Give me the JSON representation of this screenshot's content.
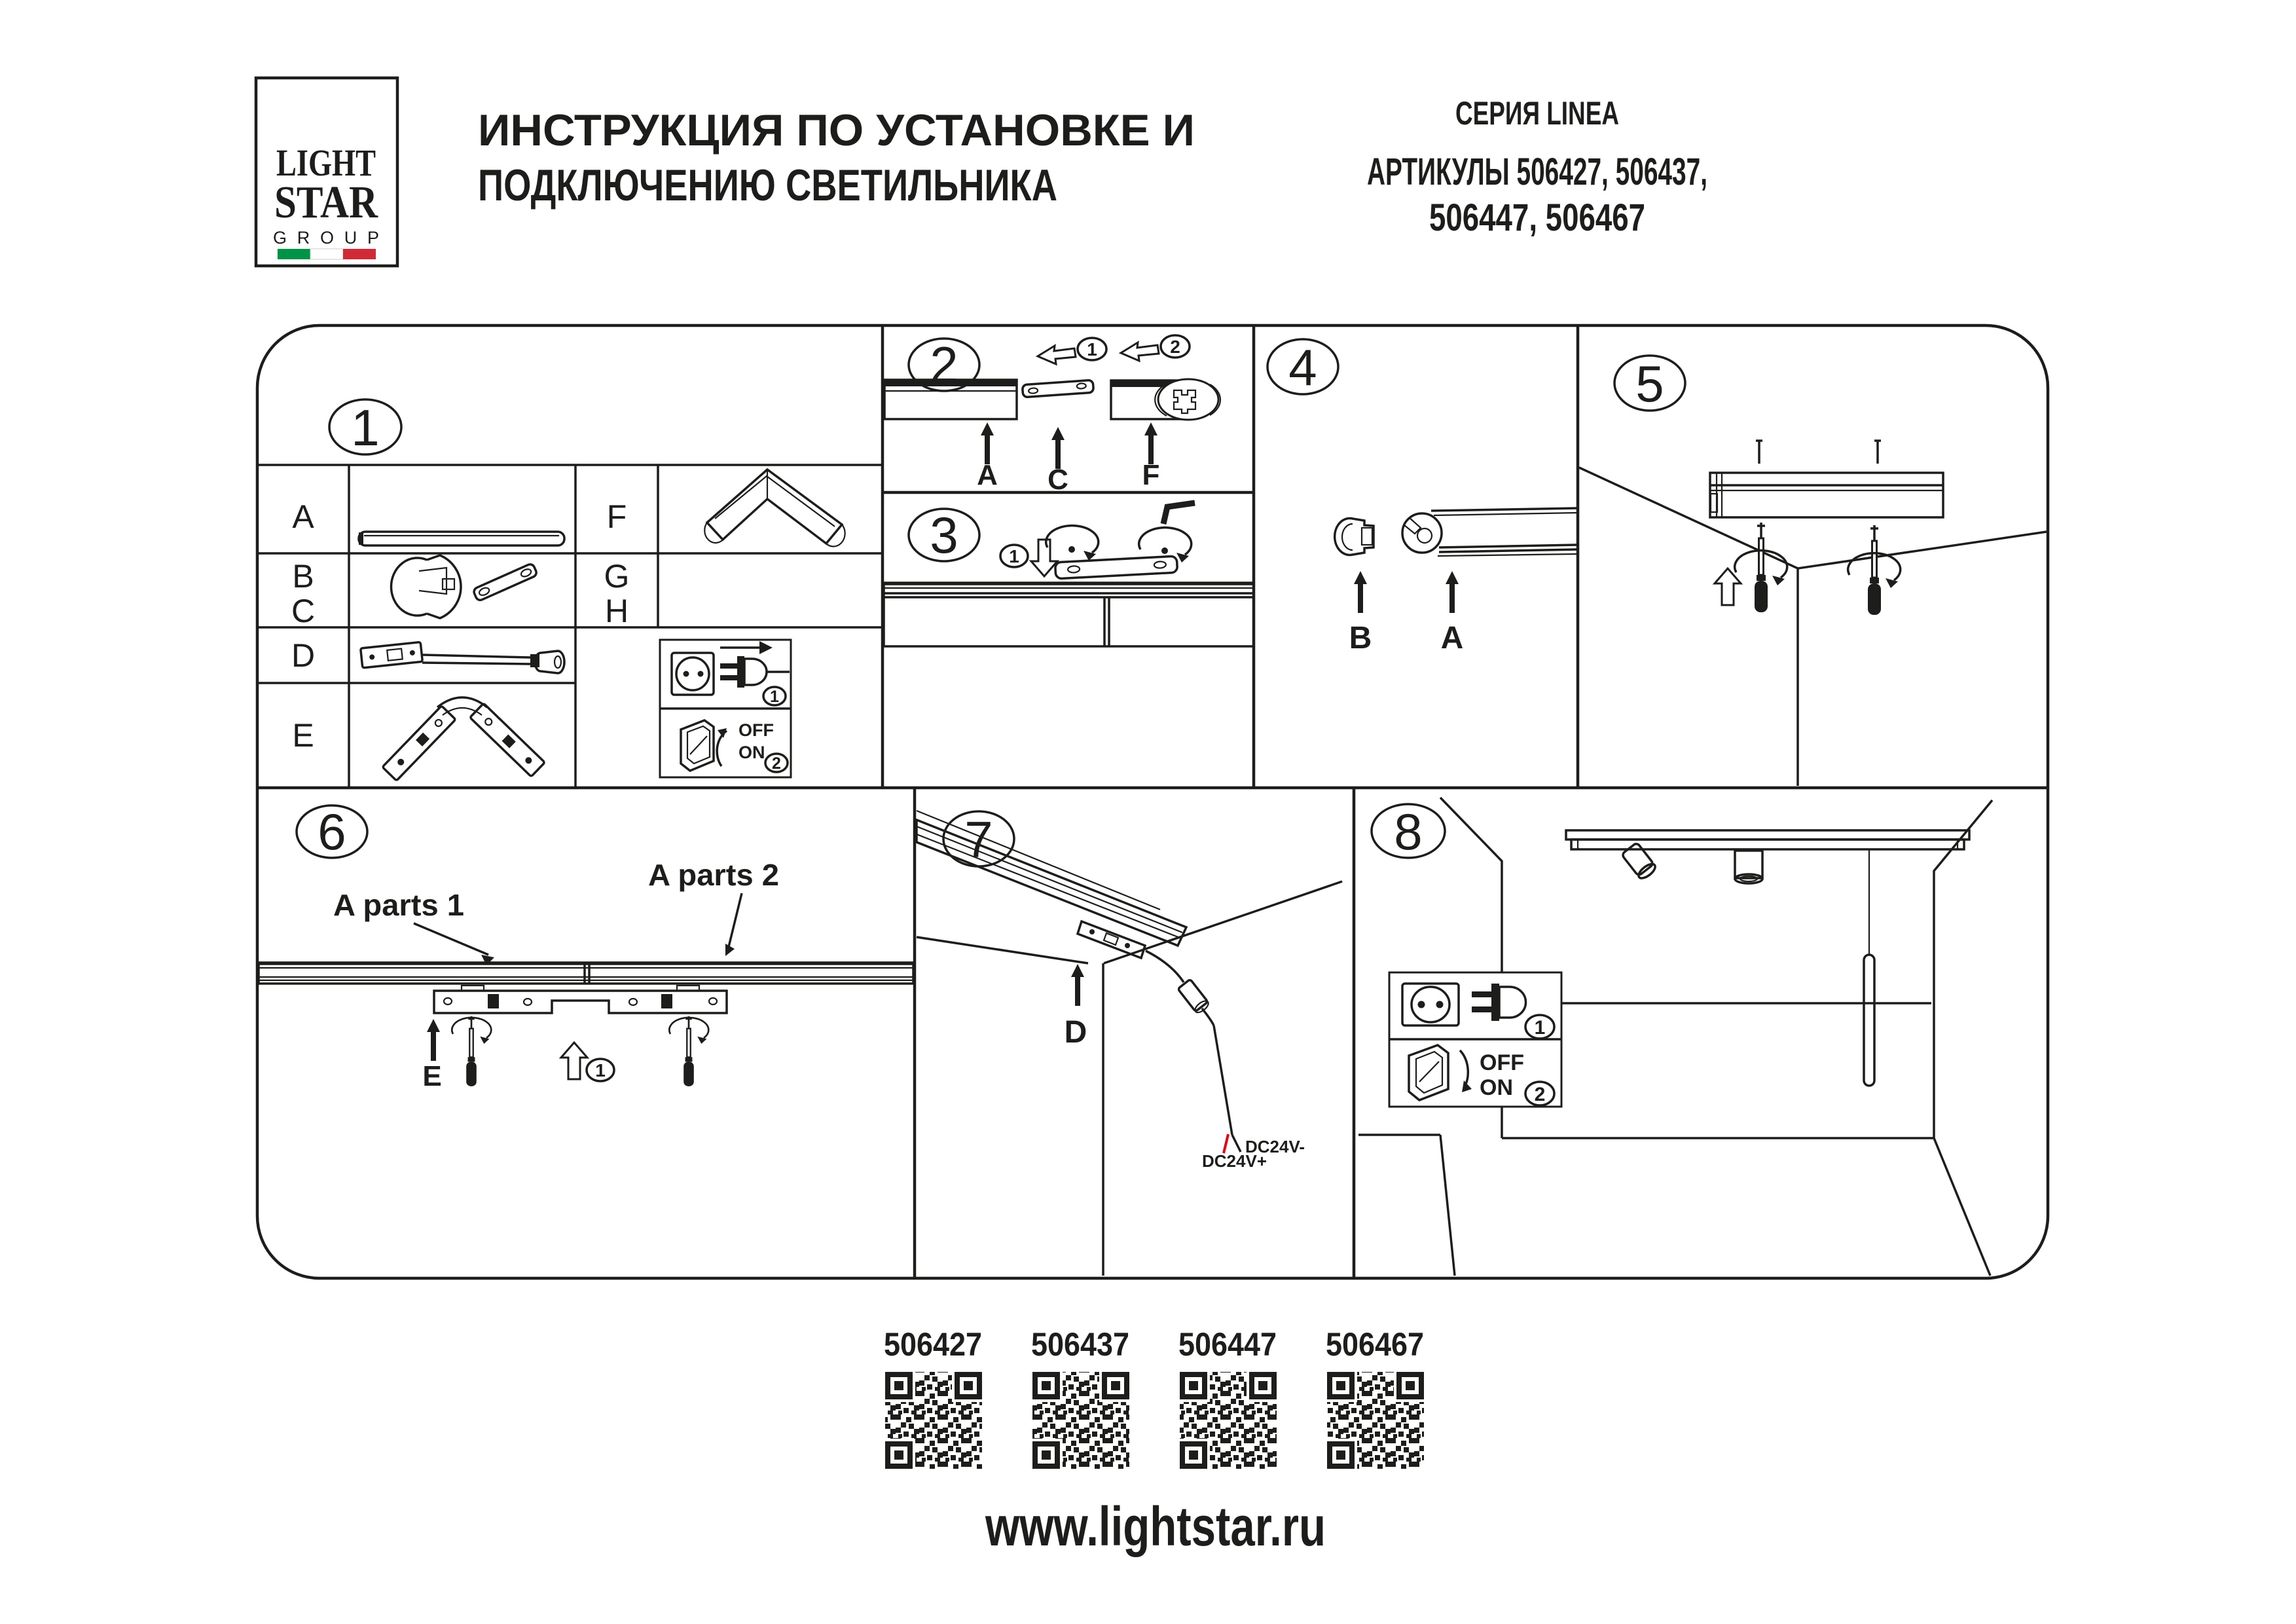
{
  "colors": {
    "ink": "#1d1d1b",
    "flag_green": "#009246",
    "flag_white": "#ffffff",
    "flag_red": "#ce2b37",
    "wire_red": "#e30613"
  },
  "logo": {
    "line1": "LIGHT",
    "line2": "STAR",
    "line3": "GROUP"
  },
  "header": {
    "title_line1": "ИНСТРУКЦИЯ ПО УСТАНОВКЕ И",
    "title_line2": "ПОДКЛЮЧЕНИЮ СВЕТИЛЬНИКА",
    "series": "СЕРИЯ LINEA",
    "articles_line1": "АРТИКУЛЫ 506427, 506437,",
    "articles_line2": "506447, 506467"
  },
  "steps": [
    "1",
    "2",
    "3",
    "4",
    "5",
    "6",
    "7",
    "8"
  ],
  "parts": {
    "a": "A",
    "b": "B",
    "c": "C",
    "d": "D",
    "e": "E",
    "f": "F",
    "g": "G",
    "h": "H"
  },
  "badges": {
    "b1": "1",
    "b2": "2"
  },
  "power": {
    "off": "OFF",
    "on": "ON"
  },
  "panel6": {
    "parts1": "A parts 1",
    "parts2": "A parts 2"
  },
  "panel7": {
    "dc_minus": "DC24V-",
    "dc_plus": "DC24V+"
  },
  "qr": {
    "codes": [
      "506427",
      "506437",
      "506447",
      "506467"
    ]
  },
  "footer": {
    "url": "www.lightstar.ru"
  }
}
